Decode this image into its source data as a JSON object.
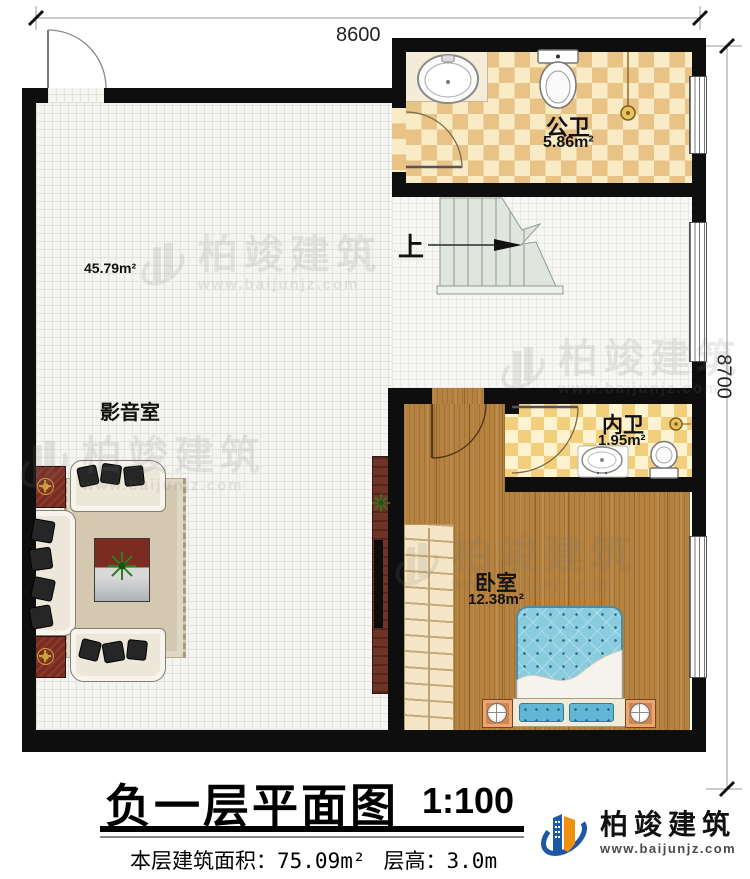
{
  "dimensions": {
    "top": "8600",
    "right": "8700"
  },
  "rooms": {
    "public_bath": {
      "name": "公卫",
      "area": "5.86m²"
    },
    "media_room": {
      "name": "影音室",
      "area": "45.79m²"
    },
    "inner_bath": {
      "name": "内卫",
      "area": "1.95m²"
    },
    "bedroom": {
      "name": "卧室",
      "area": "12.38m²"
    }
  },
  "stairs": {
    "direction_label": "上"
  },
  "title": {
    "main": "负一层平面图",
    "scale": "1:100"
  },
  "info": {
    "area_label": "本层建筑面积：",
    "area_value": "75.09m²",
    "height_label": "层高：",
    "height_value": "3.0m"
  },
  "brand": {
    "name": "柏竣建筑",
    "url": "www.baijunjz.com"
  },
  "watermark": {
    "name": "柏竣建筑",
    "url": "www.baijunjz.com"
  },
  "colors": {
    "wall": "#0e0e0e",
    "public_bath_tile": "#e9c285",
    "inner_bath_tile": "#f2cf7c",
    "bedroom_wood": "#b58340",
    "stair_fill": "#e0e6dd",
    "bed_blue": "#8accdf",
    "brand_blue": "#1e57a5",
    "brand_orange": "#f0900f"
  }
}
